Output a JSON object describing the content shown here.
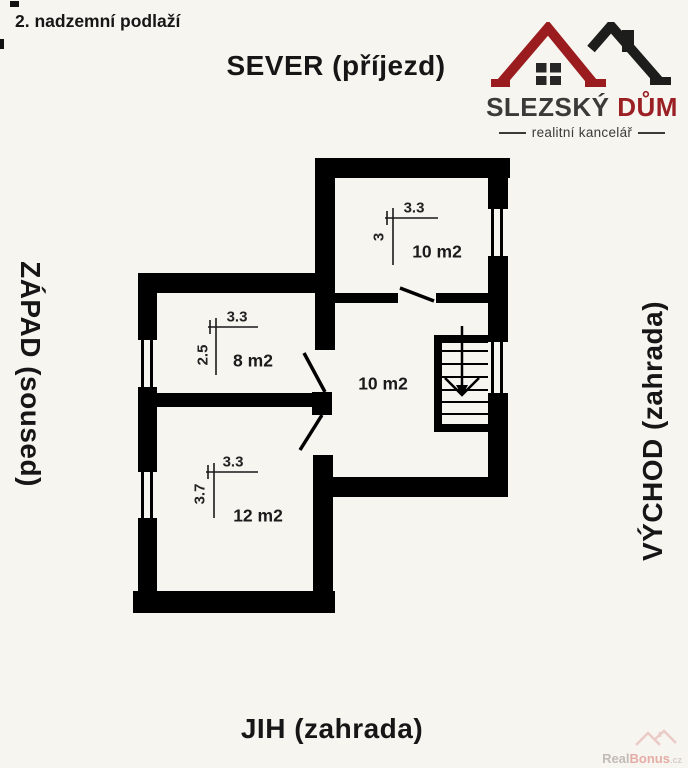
{
  "header": {
    "floor_title": "2. nadzemní podlaží"
  },
  "compass": {
    "north": "SEVER (příjezd)",
    "west": "ZÁPAD (soused)",
    "east": "VÝCHOD (zahrada)",
    "south": "JIH (zahrada)"
  },
  "logo": {
    "brand_primary": "SLEZSKÝ",
    "brand_accent": "DŮM",
    "tagline": "realitní kancelář"
  },
  "plan": {
    "rooms": [
      {
        "name": "room-north",
        "area_label": "10 m2",
        "dim_width": "3.3",
        "dim_height": "3"
      },
      {
        "name": "room-west-upper",
        "area_label": "8 m2",
        "dim_width": "3.3",
        "dim_height": "2.5"
      },
      {
        "name": "room-west-lower",
        "area_label": "12 m2",
        "dim_width": "3.3",
        "dim_height": "3.7"
      },
      {
        "name": "hall",
        "area_label": "10 m2"
      }
    ]
  },
  "watermark": {
    "part1": "Real",
    "part2": "Bonus",
    "part3": ".cz"
  },
  "colors": {
    "wall": "#000000",
    "background": "#f7f5f0",
    "logo_roof_red": "#9b1c1f",
    "logo_roof_black": "#1d1d1b",
    "brand_accent_color": "#9b2024"
  }
}
